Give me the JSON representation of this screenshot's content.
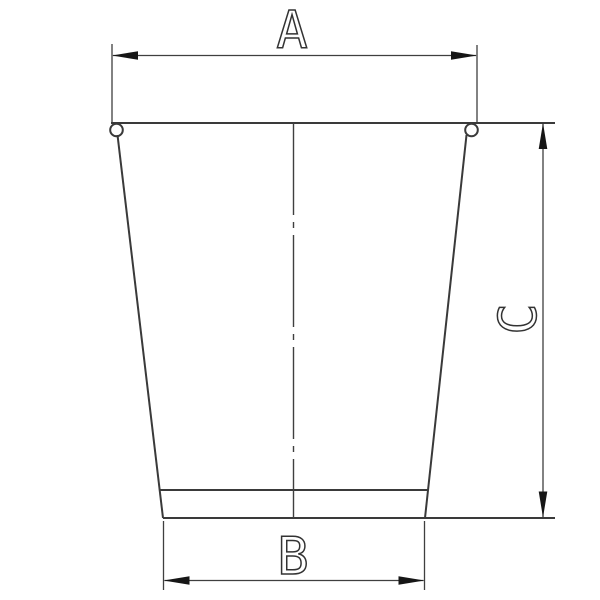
{
  "page": {
    "background_color": "#ffffff",
    "line_color": "#3a3a3a",
    "arrow_color": "#161616"
  },
  "drawing": {
    "kind": "engineering-dimension-drawing",
    "object": "tapered cup with rolled rim beads and recessed bottom band",
    "labels": {
      "a": "A",
      "b": "B",
      "c": "C"
    },
    "dimensions": [
      {
        "label": "A",
        "orientation": "horizontal",
        "spans": "top rim width"
      },
      {
        "label": "B",
        "orientation": "horizontal",
        "spans": "bottom base width"
      },
      {
        "label": "C",
        "orientation": "vertical",
        "spans": "body height"
      }
    ]
  }
}
